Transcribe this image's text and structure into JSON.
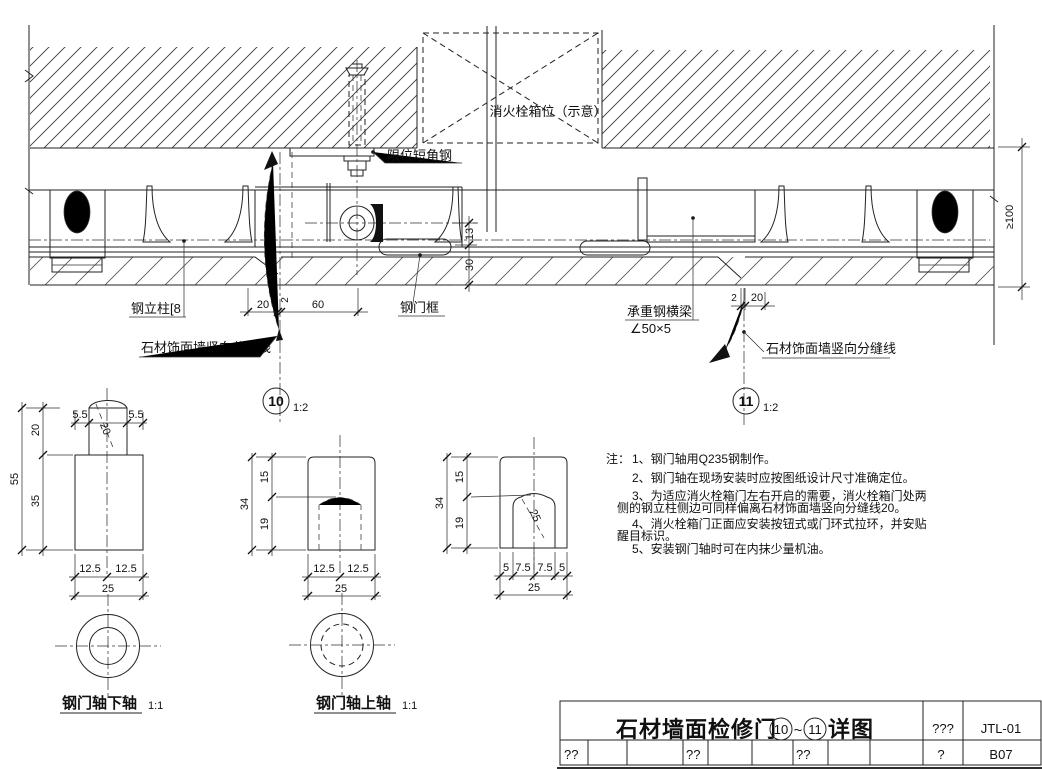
{
  "drawing": {
    "labels": {
      "fire_box": "消火栓箱位（示意）",
      "limit_angle_steel": "限位短角钢",
      "steel_column": "钢立柱[8",
      "steel_door_frame": "钢门框",
      "beam_name": "承重钢横梁",
      "beam_spec": "∠50×5",
      "joint_line_left": "石材饰面墙竖向分缝线",
      "joint_line_right": "石材饰面墙竖向分缝线"
    },
    "dims": {
      "d13": "13",
      "d30": "30",
      "d20_left": "20",
      "d60": "60",
      "d2_left": "2",
      "d2_right": "2",
      "d20_right": "20",
      "min100": "≥100"
    }
  },
  "markers": {
    "left": {
      "num": "10",
      "scale": "1:2"
    },
    "right": {
      "num": "11",
      "scale": "1:2"
    }
  },
  "pin_detail": {
    "label": "钢门轴下轴",
    "scale": "1:1",
    "dims": {
      "top_left": "5.5",
      "top_right": "5.5",
      "neck_h": "20",
      "total_h": "55",
      "body_h": "35",
      "half_l": "12.5",
      "half_r": "12.5",
      "width": "25",
      "dia": "20"
    }
  },
  "sleeve_detail": {
    "label": "钢门轴上轴",
    "scale": "1:1",
    "dims": {
      "top_h": "15",
      "hole_h": "19",
      "total_h": "34",
      "half_l": "12.5",
      "half_r": "12.5",
      "width": "25"
    }
  },
  "socket_detail": {
    "dims": {
      "top_h": "15",
      "hole_h": "19",
      "total_h": "34",
      "s1": "5",
      "s2": "7.5",
      "s3": "7.5",
      "s4": "5",
      "width": "25",
      "dia": "25"
    }
  },
  "notes": {
    "prefix": "注：",
    "line1": "1、钢门轴用Q235钢制作。",
    "line2": "2、钢门轴在现场安装时应按图纸设计尺寸准确定位。",
    "line3": "3、为适应消火栓箱门左右开启的需要，消火栓箱门处两",
    "line3b": "侧的钢立柱侧边可同样偏离石材饰面墙竖向分缝线20。",
    "line4": "4、消火栓箱门正面应安装按钮式或门环式拉环，并安贴",
    "line4b": "醒目标识。",
    "line5": "5、安装钢门轴时可在内抹少量机油。"
  },
  "title_block": {
    "title_prefix": "石材墙面检修门",
    "detail_from": "10",
    "tilde": "~",
    "detail_to": "11",
    "title_suffix": "详图",
    "col_q3": "???",
    "drawing_code": "JTL-01",
    "cell_q1": "??",
    "cell_q2": "??",
    "cell_q3": "??",
    "cell_q4": "?",
    "sheet_no": "B07"
  }
}
